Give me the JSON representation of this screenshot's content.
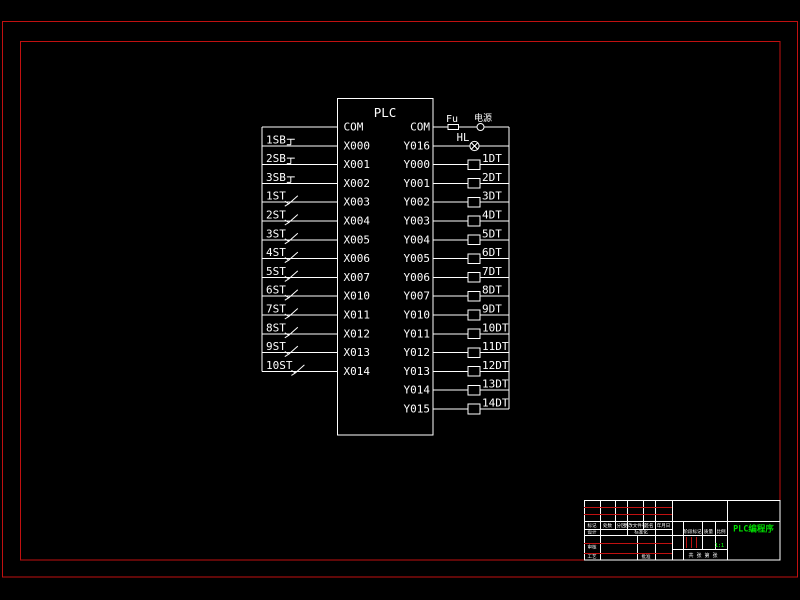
{
  "colors": {
    "background": "#000000",
    "drawing_line": "#ffffff",
    "frame_red": "#c01010",
    "title_green": "#00dd00"
  },
  "plc": {
    "title": "PLC",
    "left_pins": [
      "COM",
      "X000",
      "X001",
      "X002",
      "X003",
      "X004",
      "X005",
      "X006",
      "X007",
      "X010",
      "X011",
      "X012",
      "X013",
      "X014"
    ],
    "right_pins": [
      "COM",
      "Y016",
      "Y000",
      "Y001",
      "Y002",
      "Y003",
      "Y004",
      "Y005",
      "Y006",
      "Y007",
      "Y010",
      "Y011",
      "Y012",
      "Y013",
      "Y014",
      "Y015"
    ]
  },
  "inputs": [
    {
      "label": "1SB",
      "kind": "pushbutton"
    },
    {
      "label": "2SB",
      "kind": "pushbutton"
    },
    {
      "label": "3SB",
      "kind": "pushbutton"
    },
    {
      "label": "1ST",
      "kind": "limit-switch"
    },
    {
      "label": "2ST",
      "kind": "limit-switch"
    },
    {
      "label": "3ST",
      "kind": "limit-switch"
    },
    {
      "label": "4ST",
      "kind": "limit-switch"
    },
    {
      "label": "5ST",
      "kind": "limit-switch"
    },
    {
      "label": "6ST",
      "kind": "limit-switch"
    },
    {
      "label": "7ST",
      "kind": "limit-switch"
    },
    {
      "label": "8ST",
      "kind": "limit-switch"
    },
    {
      "label": "9ST",
      "kind": "limit-switch"
    },
    {
      "label": "10ST",
      "kind": "limit-switch"
    }
  ],
  "outputs": [
    "1DT",
    "2DT",
    "3DT",
    "4DT",
    "5DT",
    "6DT",
    "7DT",
    "8DT",
    "9DT",
    "10DT",
    "11DT",
    "12DT",
    "13DT",
    "14DT"
  ],
  "power_circuit": {
    "fuse": "Fu",
    "source": "电源",
    "lamp": "HL"
  },
  "title_block": {
    "drawing_title": "PLC编程序",
    "rev_headers": [
      "标记",
      "处数",
      "分区",
      "更改文件号",
      "签名",
      "年月日"
    ],
    "left_labels": {
      "design": "设计",
      "standardize": "标准化",
      "audit": "审核",
      "process": "工艺",
      "approve": "批准"
    },
    "mid_headers": {
      "stage": "阶段标记",
      "quality": "质量",
      "scale": "比例"
    },
    "scale_value": "1:1",
    "sheet_row": "共 张 第 张"
  }
}
